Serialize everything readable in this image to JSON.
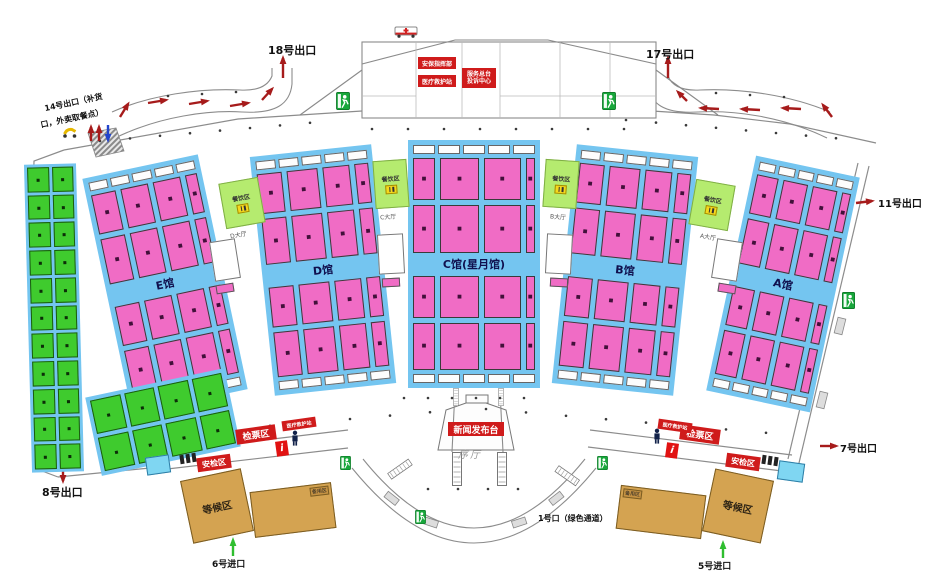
{
  "halls": [
    {
      "label": "E馆"
    },
    {
      "label": "D馆"
    },
    {
      "label": "C馆(星月馆)"
    },
    {
      "label": "B馆"
    },
    {
      "label": "A馆"
    }
  ],
  "booth_marker": "■",
  "dining": {
    "label": "餐饮区",
    "lobbies": [
      "D大厅",
      "C大厅",
      "B大厅",
      "A大厅"
    ]
  },
  "labels": {
    "exit18": "18号出口",
    "exit17": "17号出口",
    "exit14_line1": "14号出口（补货",
    "exit14_line2": "口，外卖取餐点）",
    "exit11": "11号出口",
    "exit7": "7号出口",
    "exit8": "8号出口",
    "entry6": "6号进口",
    "entry5": "5号进口",
    "entry1": "1号口（绿色通道）",
    "security_hq": "安保指挥部",
    "medical": "医疗救护站",
    "service_line1": "服务总台",
    "service_line2": "投诉中心",
    "press": "新闻发布台",
    "foyer": "序厅",
    "ticket": "检票区",
    "security": "安检区",
    "waiting": "等候区",
    "reserve": "备用区",
    "info": "i"
  },
  "colors": {
    "hall_blue": "#74C5F0",
    "booth_pink": "#F06CC5",
    "booth_green": "#3FCB2E",
    "dining_green": "#B5EB6F",
    "waiting_tan": "#D4A351",
    "banner_red": "#CF1B1B",
    "exit_sign_green": "#18A73B",
    "arrow_red": "#A61B1B",
    "arrow_blue": "#2244CC",
    "arrow_green": "#2FBE2F"
  }
}
